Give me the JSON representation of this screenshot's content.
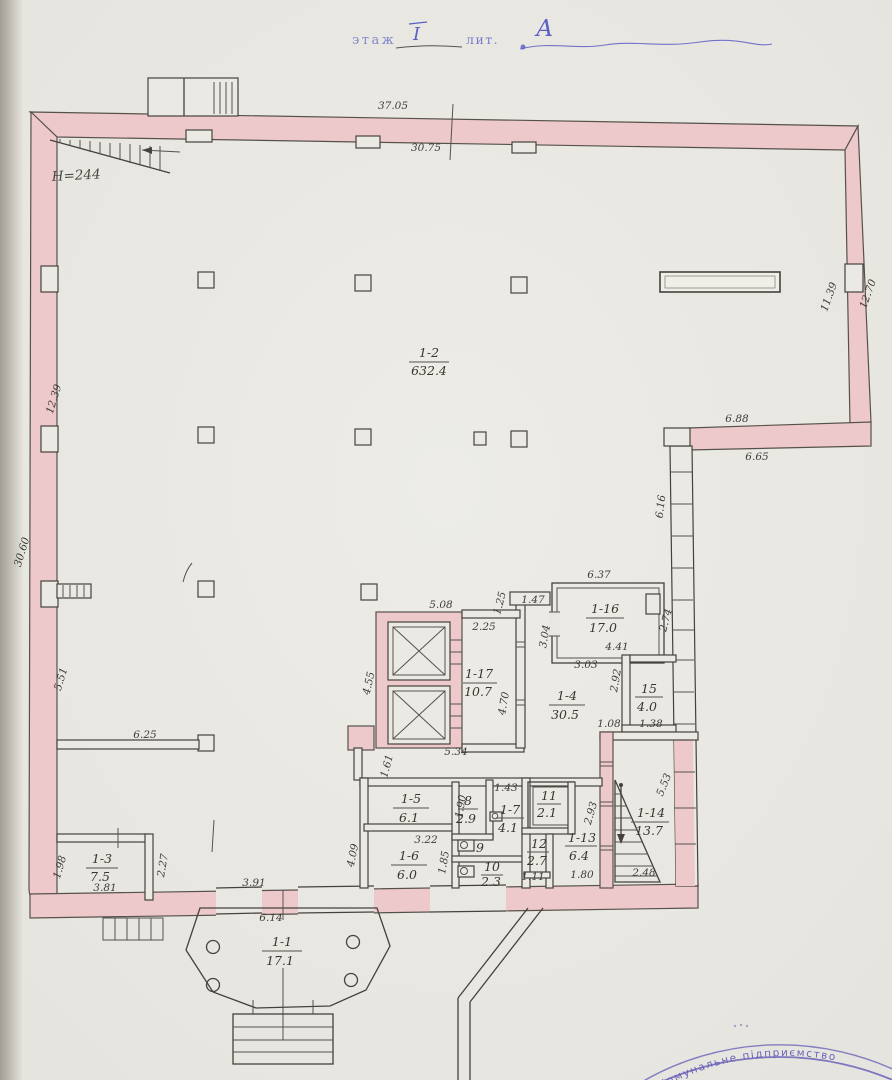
{
  "title": {
    "floor_word": "этаж",
    "floor_value": "I",
    "lit_word": "лит.",
    "lit_value": "А"
  },
  "notes": {
    "height": "H=244"
  },
  "stamp": {
    "text": "Комунальне підприємство"
  },
  "rooms": {
    "r1": {
      "id": "1-1",
      "area": "17.1"
    },
    "r2": {
      "id": "1-2",
      "area": "632.4"
    },
    "r3": {
      "id": "1-3",
      "area": "7.5"
    },
    "r4": {
      "id": "1-4",
      "area": "30.5"
    },
    "r5": {
      "id": "1-5",
      "area": "6.1"
    },
    "r6": {
      "id": "1-6",
      "area": "6.0"
    },
    "r7": {
      "id": "1-7",
      "area": "4.1"
    },
    "r8": {
      "id": "8",
      "area": "2.9"
    },
    "r9": {
      "id": "9"
    },
    "r10": {
      "id": "10",
      "area": "2.3"
    },
    "r11": {
      "id": "11",
      "area": "2.1"
    },
    "r12": {
      "id": "12",
      "area": "2.7"
    },
    "r13": {
      "id": "1-13",
      "area": "6.4"
    },
    "r14": {
      "id": "1-14",
      "area": "13.7"
    },
    "r15": {
      "id": "15",
      "area": "4.0"
    },
    "r16": {
      "id": "1-16",
      "area": "17.0"
    },
    "r17": {
      "id": "1-17",
      "area": "10.7"
    }
  },
  "dims": {
    "top_outer": "37.05",
    "top_inner": "30.75",
    "left_inner": "12.39",
    "left_outer": "30.60",
    "right_inner": "11.39",
    "right_outer": "12.70",
    "notch_top": "6.88",
    "notch_bottom": "6.65",
    "notch_side": "6.16",
    "left_lower": "5.51",
    "hall_partition": "6.25",
    "elev_top": "5.08",
    "corridor_top": "2.25",
    "jog_v": "1.25",
    "jog_h": "1.47",
    "r16_top": "6.37",
    "r16_left": "3.04",
    "r16_right": "2.74",
    "r16_bottom": "4.41",
    "r16_offset": "3.03",
    "r15_wall": "2.92",
    "elev_left": "4.55",
    "r17_side": "4.70",
    "hall4_left": "1.08",
    "hall4_right": "1.38",
    "elev_bottom": "5.34",
    "block_edge": "1.61",
    "rooms_left": "4.09",
    "r5_side": "1.90",
    "r7_top": "1.43",
    "r5_bottom": "3.22",
    "r6_side": "1.85",
    "r12_below": "1.11",
    "r13_below": "1.80",
    "r14_below": "2.48",
    "r13_side": "2.93",
    "r14_side": "5.53",
    "r3_left": "1.98",
    "r3_right": "2.27",
    "r3_bottom": "3.81",
    "porch_top": "3.91",
    "porch_width": "6.14"
  }
}
